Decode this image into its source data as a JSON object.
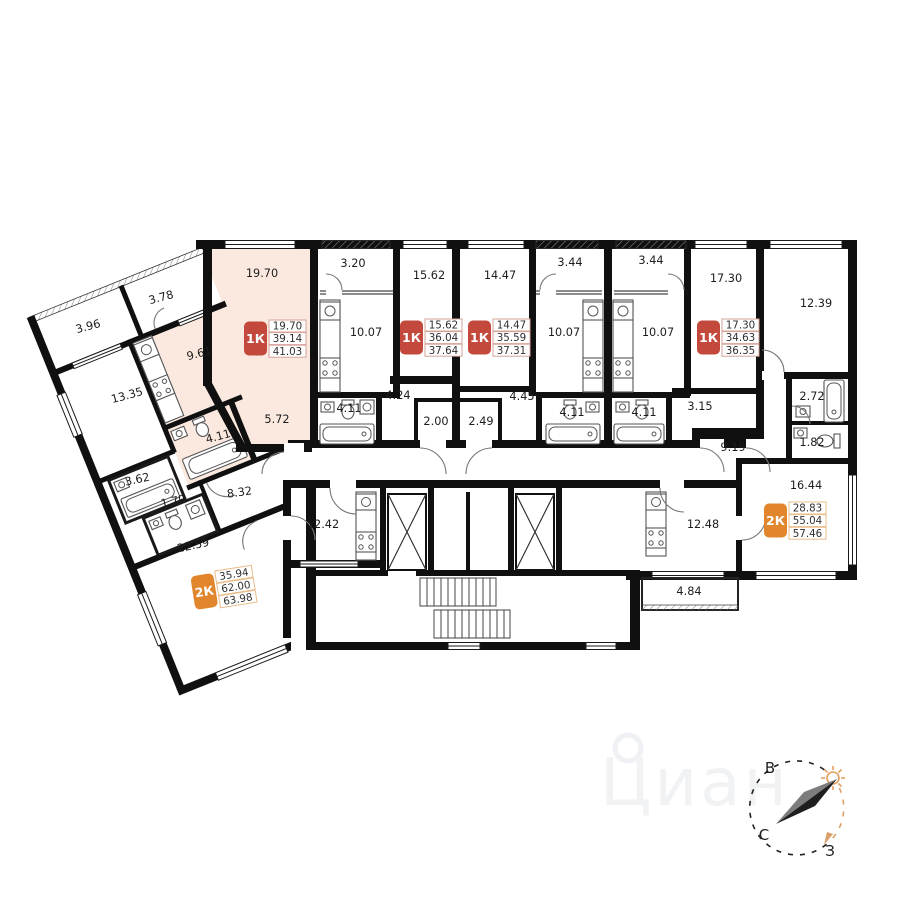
{
  "colors": {
    "highlight": "#fbe9e0",
    "badge_1k": "#c2493c",
    "badge_2k": "#e1862c"
  },
  "watermark": {
    "text": "Циан"
  },
  "compass": {
    "east": "В",
    "north": "С",
    "west": "З"
  },
  "rooms": [
    {
      "id": "apt-a-living",
      "label": "19.70"
    },
    {
      "id": "apt-a-kitchen",
      "label": "9.61"
    },
    {
      "id": "apt-a-hall",
      "label": "5.72"
    },
    {
      "id": "apt-a-bath",
      "label": "4.11"
    },
    {
      "id": "apt-a-balcony",
      "label": "3.78"
    },
    {
      "id": "l2k-balcony",
      "label": "3.96"
    },
    {
      "id": "l2k-room1",
      "label": "13.35"
    },
    {
      "id": "l2k-bath",
      "label": "3.62"
    },
    {
      "id": "l2k-wc",
      "label": "1.70"
    },
    {
      "id": "l2k-hall",
      "label": "8.32"
    },
    {
      "id": "l2k-room2",
      "label": "22.59"
    },
    {
      "id": "l2k-kitchen",
      "label": "12.42"
    },
    {
      "id": "apt-b-balcony",
      "label": "3.20"
    },
    {
      "id": "apt-b-kitchen",
      "label": "10.07"
    },
    {
      "id": "apt-b-living",
      "label": "15.62"
    },
    {
      "id": "apt-b-bath",
      "label": "4.11"
    },
    {
      "id": "apt-b-hall",
      "label": "4.24"
    },
    {
      "id": "apt-b-entry",
      "label": "2.00"
    },
    {
      "id": "apt-c-living",
      "label": "14.47"
    },
    {
      "id": "apt-c-hall",
      "label": "4.45"
    },
    {
      "id": "apt-c-entry",
      "label": "2.49"
    },
    {
      "id": "apt-c-balcony",
      "label": "3.44"
    },
    {
      "id": "apt-c-kitchen",
      "label": "10.07"
    },
    {
      "id": "apt-c-bath",
      "label": "4.11"
    },
    {
      "id": "apt-d-balcony",
      "label": "3.44"
    },
    {
      "id": "apt-d-kitchen",
      "label": "10.07"
    },
    {
      "id": "apt-d-bath",
      "label": "4.11"
    },
    {
      "id": "apt-d-living",
      "label": "17.30"
    },
    {
      "id": "apt-d-hall",
      "label": "3.15"
    },
    {
      "id": "r2k-room1",
      "label": "12.39"
    },
    {
      "id": "r2k-bath",
      "label": "2.72"
    },
    {
      "id": "r2k-wc",
      "label": "1.82"
    },
    {
      "id": "r2k-hall",
      "label": "9.19"
    },
    {
      "id": "r2k-room2",
      "label": "16.44"
    },
    {
      "id": "r2k-kitchen",
      "label": "12.48"
    },
    {
      "id": "r2k-balcony",
      "label": "4.84"
    }
  ],
  "badges": [
    {
      "id": "apt-a",
      "type": "1К",
      "values": [
        "19.70",
        "39.14",
        "41.03"
      ]
    },
    {
      "id": "apt-b",
      "type": "1К",
      "values": [
        "15.62",
        "36.04",
        "37.64"
      ]
    },
    {
      "id": "apt-c",
      "type": "1К",
      "values": [
        "14.47",
        "35.59",
        "37.31"
      ]
    },
    {
      "id": "apt-d",
      "type": "1К",
      "values": [
        "17.30",
        "34.63",
        "36.35"
      ]
    },
    {
      "id": "apt-2k-left",
      "type": "2К",
      "values": [
        "35.94",
        "62.00",
        "63.98"
      ]
    },
    {
      "id": "apt-2k-right",
      "type": "2К",
      "values": [
        "28.83",
        "55.04",
        "57.46"
      ]
    }
  ]
}
